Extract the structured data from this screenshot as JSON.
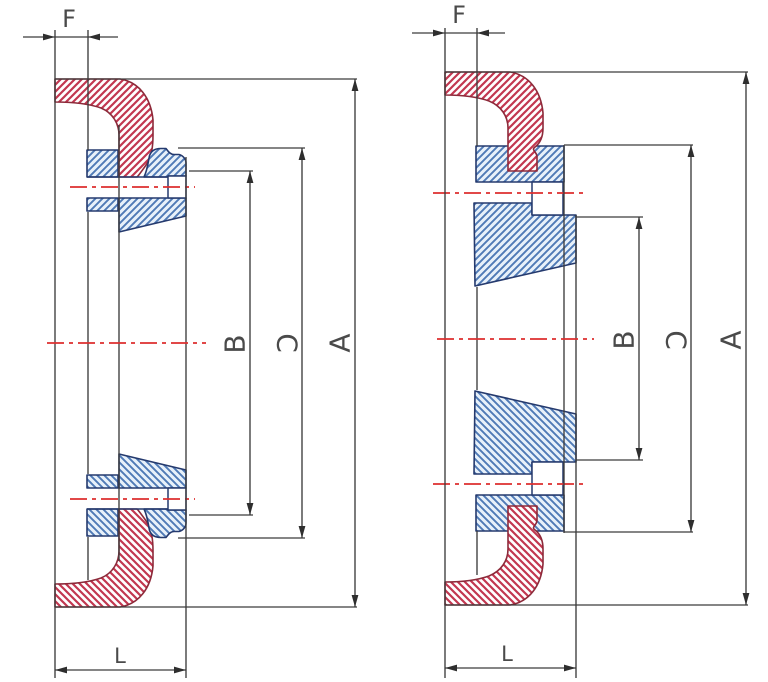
{
  "colors": {
    "red_hatch": "#c23750",
    "red_outline": "#8d2a3a",
    "blue_hatch": "#4f7ab6",
    "blue_fill": "#e8f1fa",
    "blue_outline": "#253a6e",
    "dimension_line": "#3c3c3c",
    "centerline_red": "#dd2f2f",
    "label_text": "#4a4a4a"
  },
  "diagrams": [
    {
      "id": "left",
      "dim_labels": {
        "F": "F",
        "B": "B",
        "C": "C",
        "A": "A",
        "L": "L"
      }
    },
    {
      "id": "right",
      "dim_labels": {
        "F": "F",
        "B": "B",
        "C": "C",
        "A": "A",
        "L": "L"
      }
    }
  ]
}
